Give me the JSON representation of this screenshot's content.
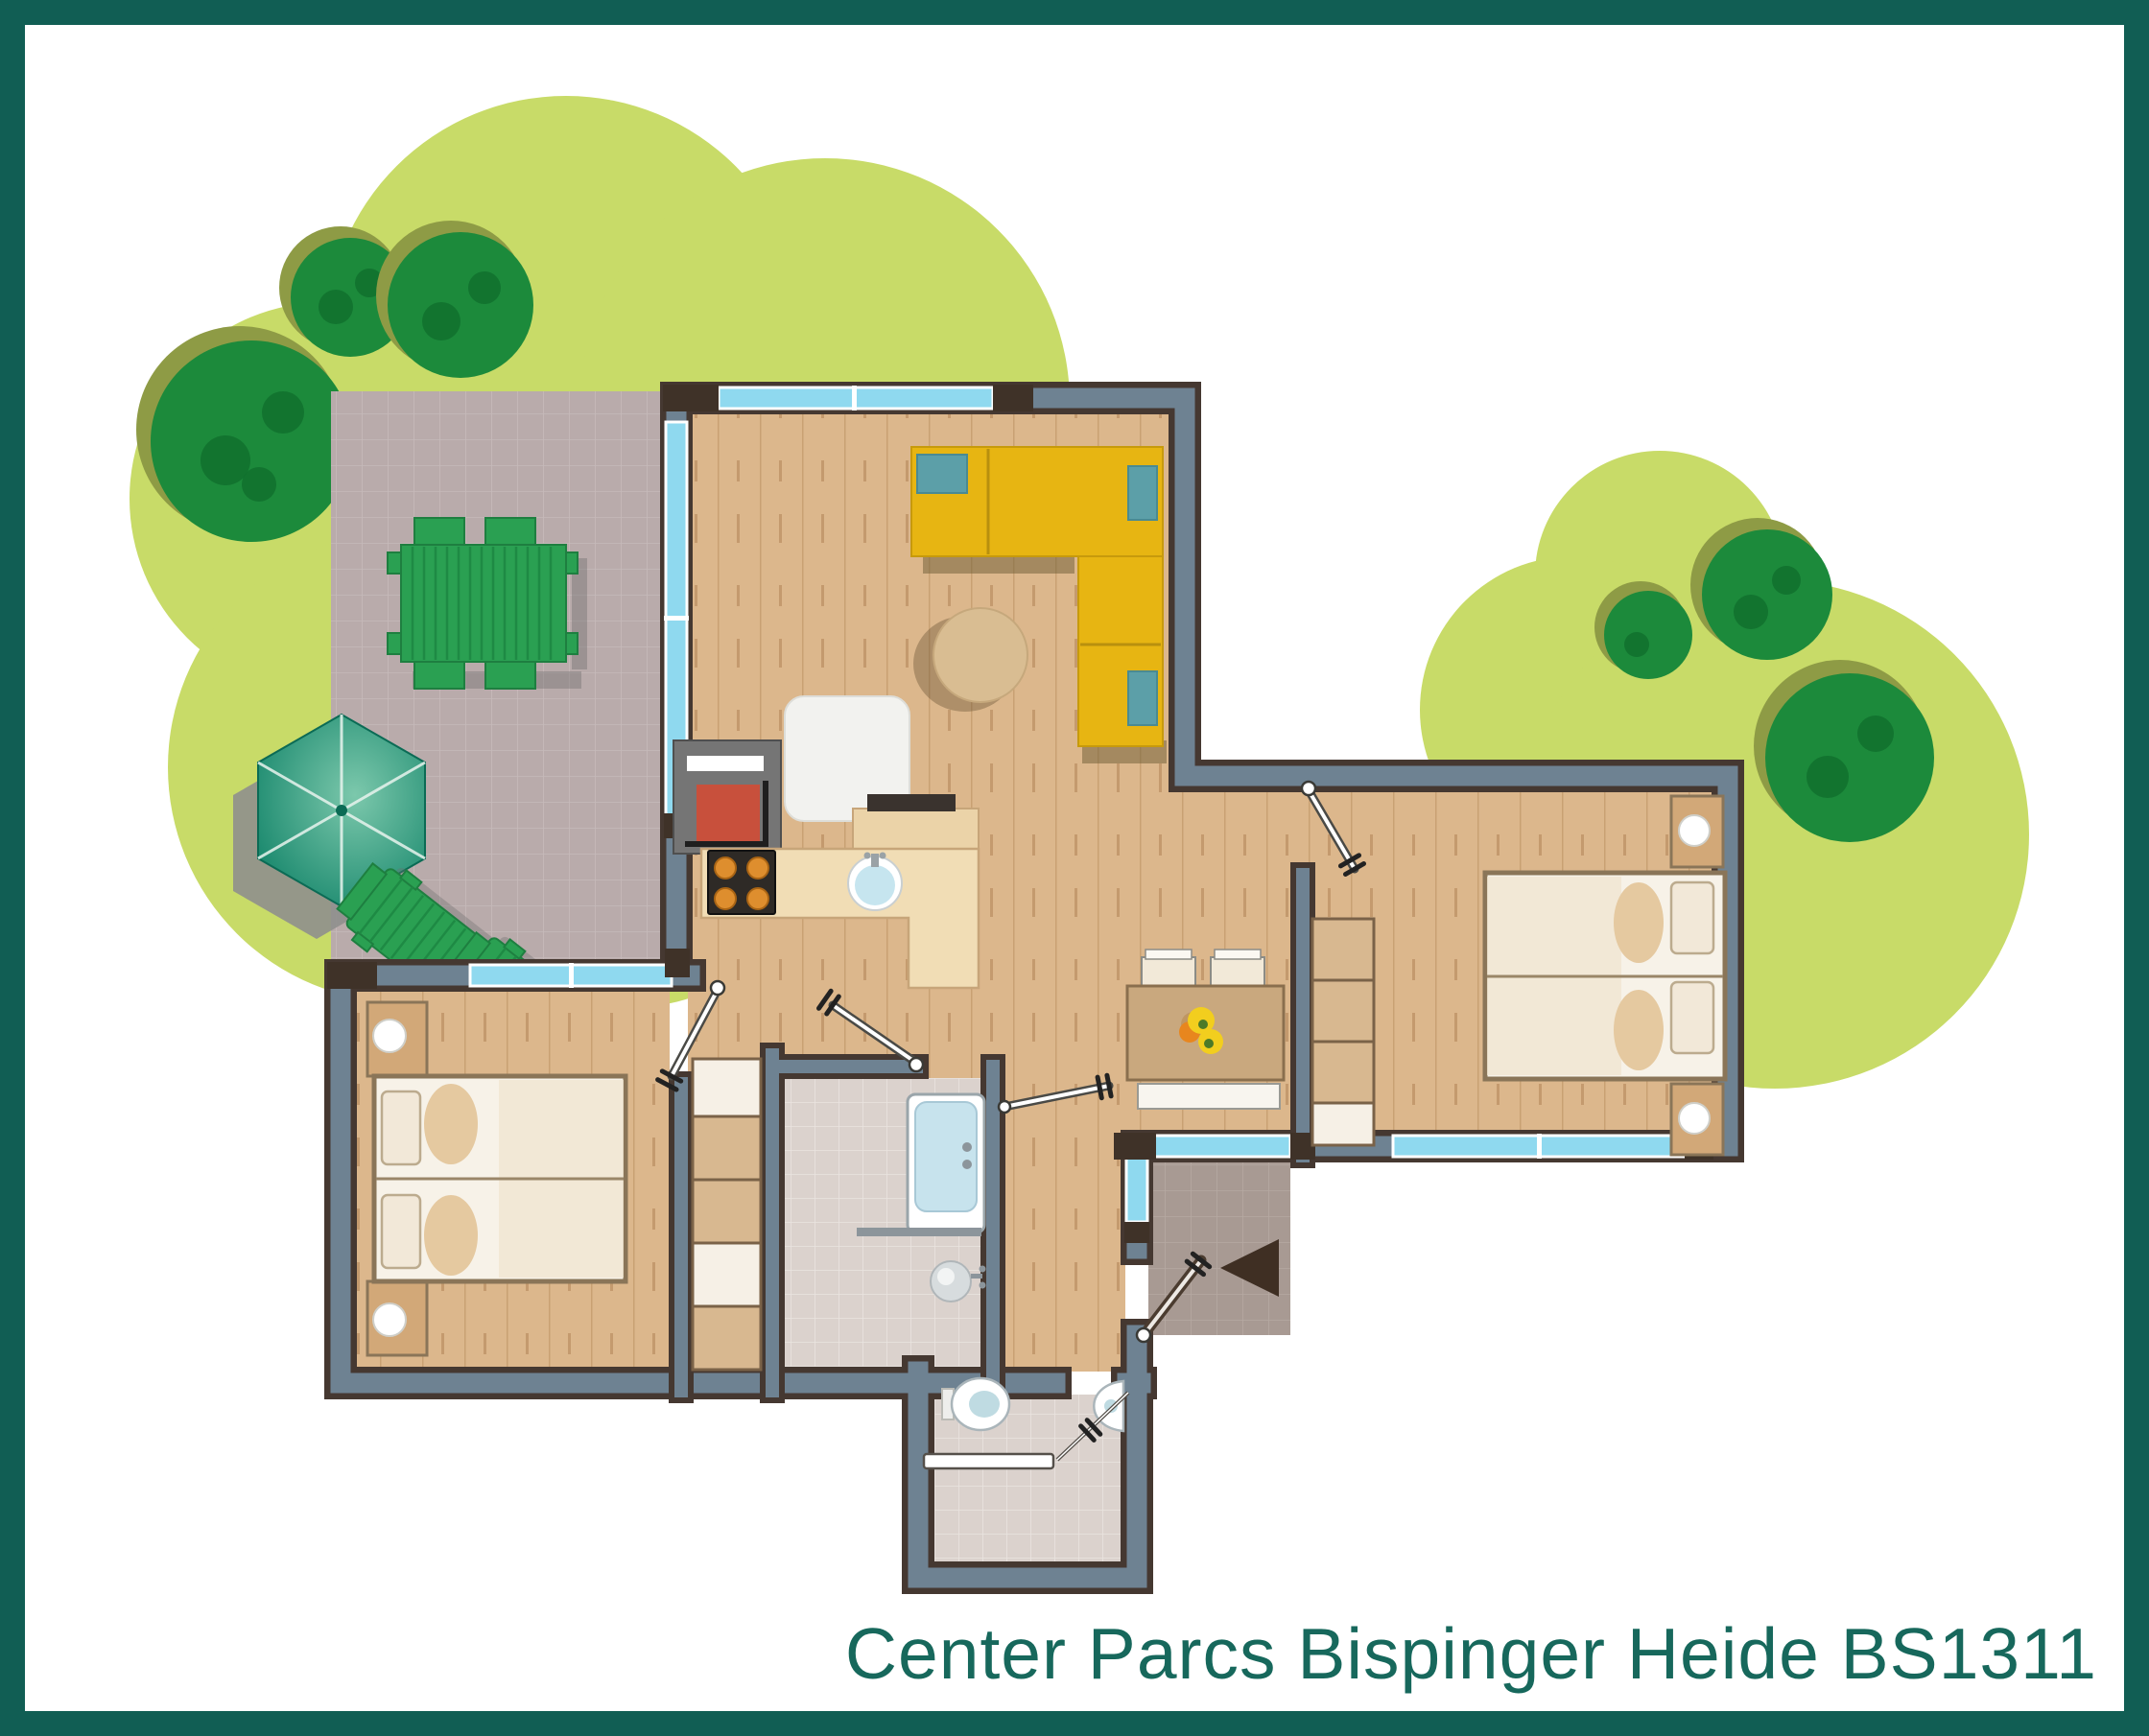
{
  "title": "Center Parcs Bispinger Heide BS1311",
  "colors": {
    "frame": "#115E54",
    "title": "#17685C",
    "canopy": "#C8DB68",
    "bush": "#1C8A3B",
    "bush_shadow": "#8E9B45",
    "bush_dark": "#10702E",
    "patio": "#B9ABAB",
    "porch": "#A89A93",
    "wall_fill": "#6E8292",
    "wall_edge": "#453831",
    "window": "#8FD9EF",
    "wood_floor": "#DCB78C",
    "bath_tile": "#DBD2CD",
    "sofa": "#E7B512",
    "cushion": "#5C9FA8",
    "garden_furniture": "#2AA052",
    "umbrella_dark": "#0E8166",
    "umbrella_light": "#7CC8AC",
    "kitchen_counter": "#F1DDB5",
    "dining_table": "#C9A87E",
    "fireplace_red": "#C8503C",
    "entrance_arrow": "#3F2F23"
  }
}
